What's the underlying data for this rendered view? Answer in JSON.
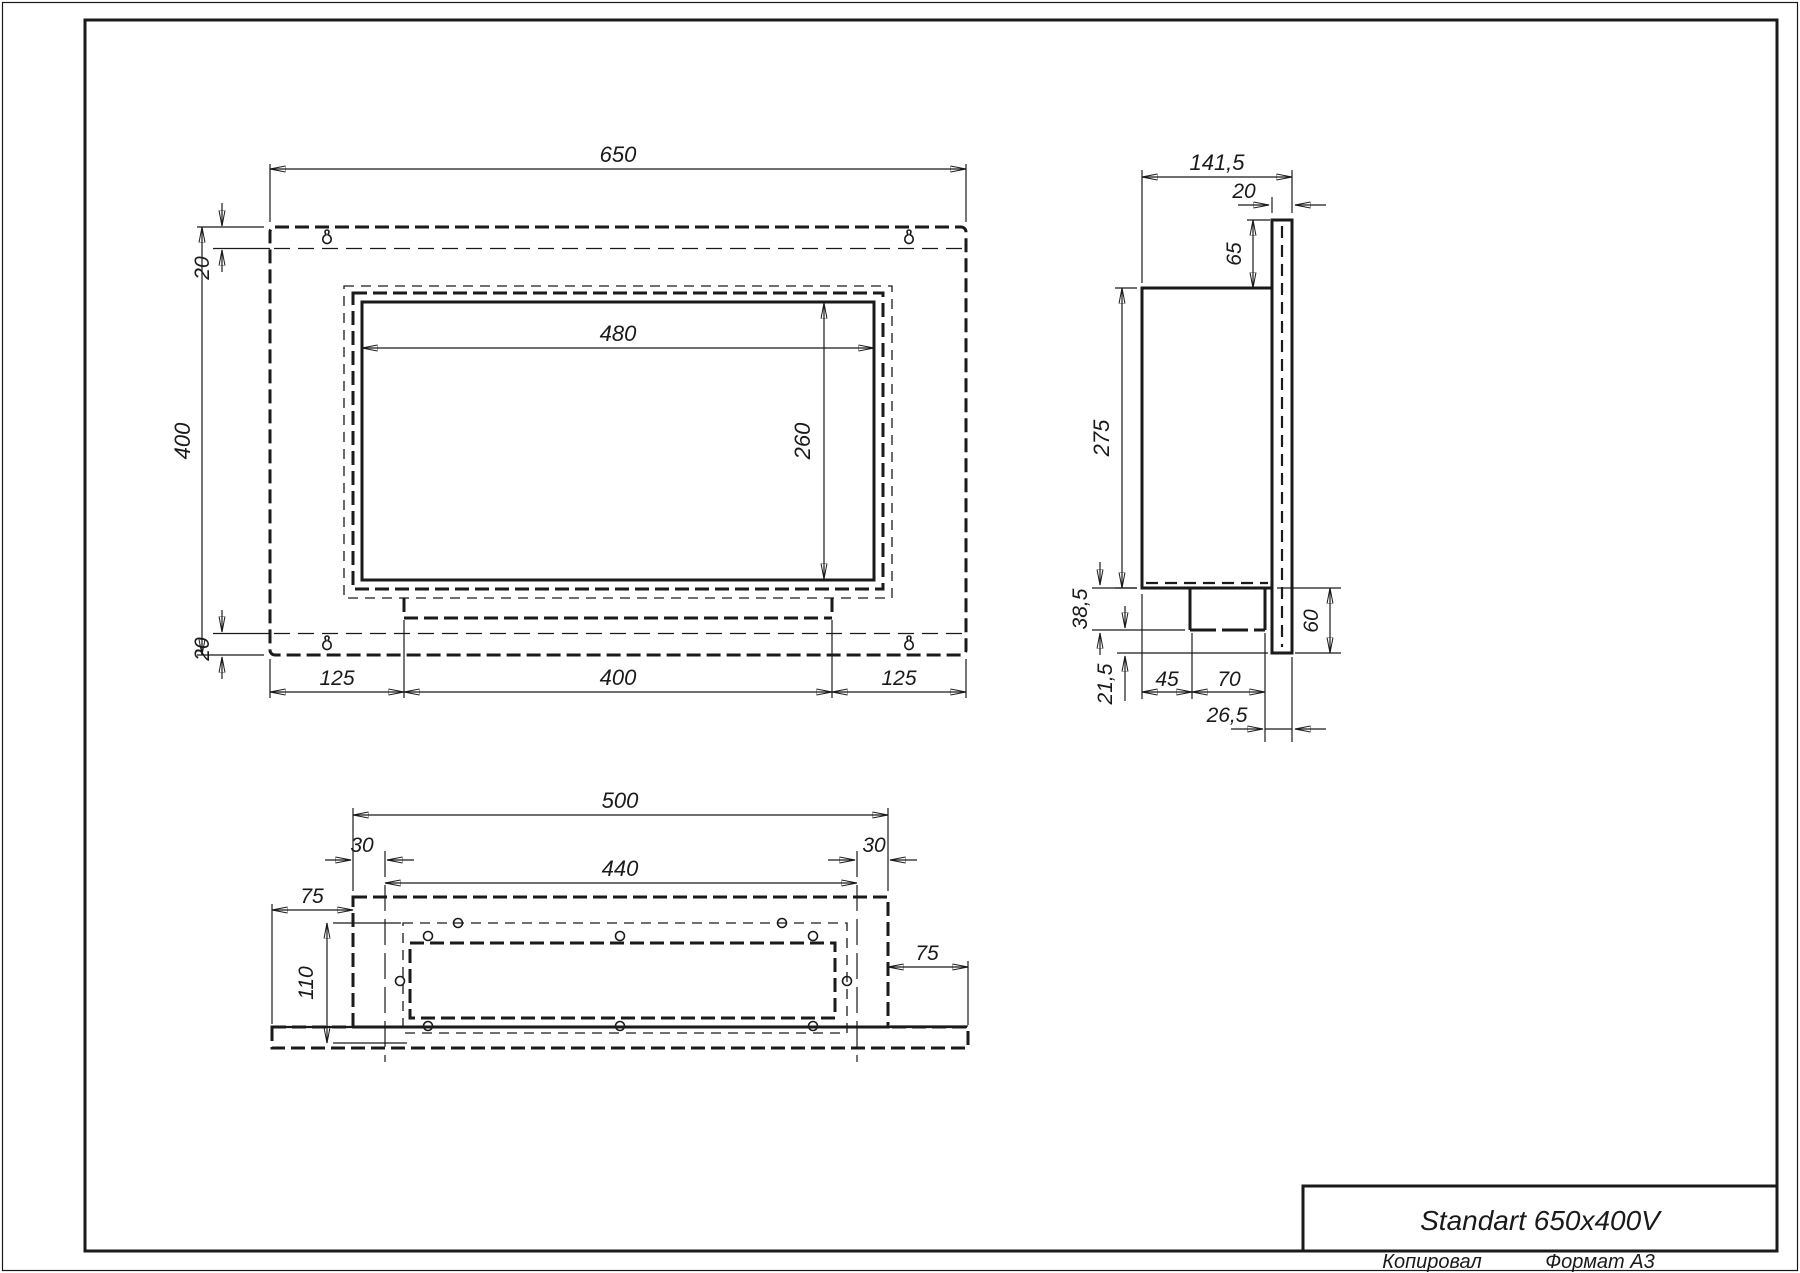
{
  "title_block": {
    "title": "Standart 650x400V",
    "copied_label": "Копировал",
    "format_label": "Формат А3"
  },
  "front_view": {
    "total_width": "650",
    "total_height": "400",
    "top_margin": "20",
    "bottom_margin": "20",
    "opening_width": "480",
    "opening_height": "260",
    "bottom_left_offset": "125",
    "tray_width": "400",
    "bottom_right_offset": "125"
  },
  "side_view": {
    "total_depth": "141,5",
    "flange_thickness": "20",
    "top_offset": "65",
    "body_height": "275",
    "tray_drop": "38,5",
    "lower_lip": "21,5",
    "front_gap": "45",
    "burner_depth": "70",
    "back_gap": "26,5",
    "bottom_height": "60"
  },
  "bottom_view": {
    "body_width": "500",
    "inset_left": "30",
    "holes_span": "440",
    "inset_right": "30",
    "wing_left": "75",
    "wing_right": "75",
    "depth": "110"
  }
}
